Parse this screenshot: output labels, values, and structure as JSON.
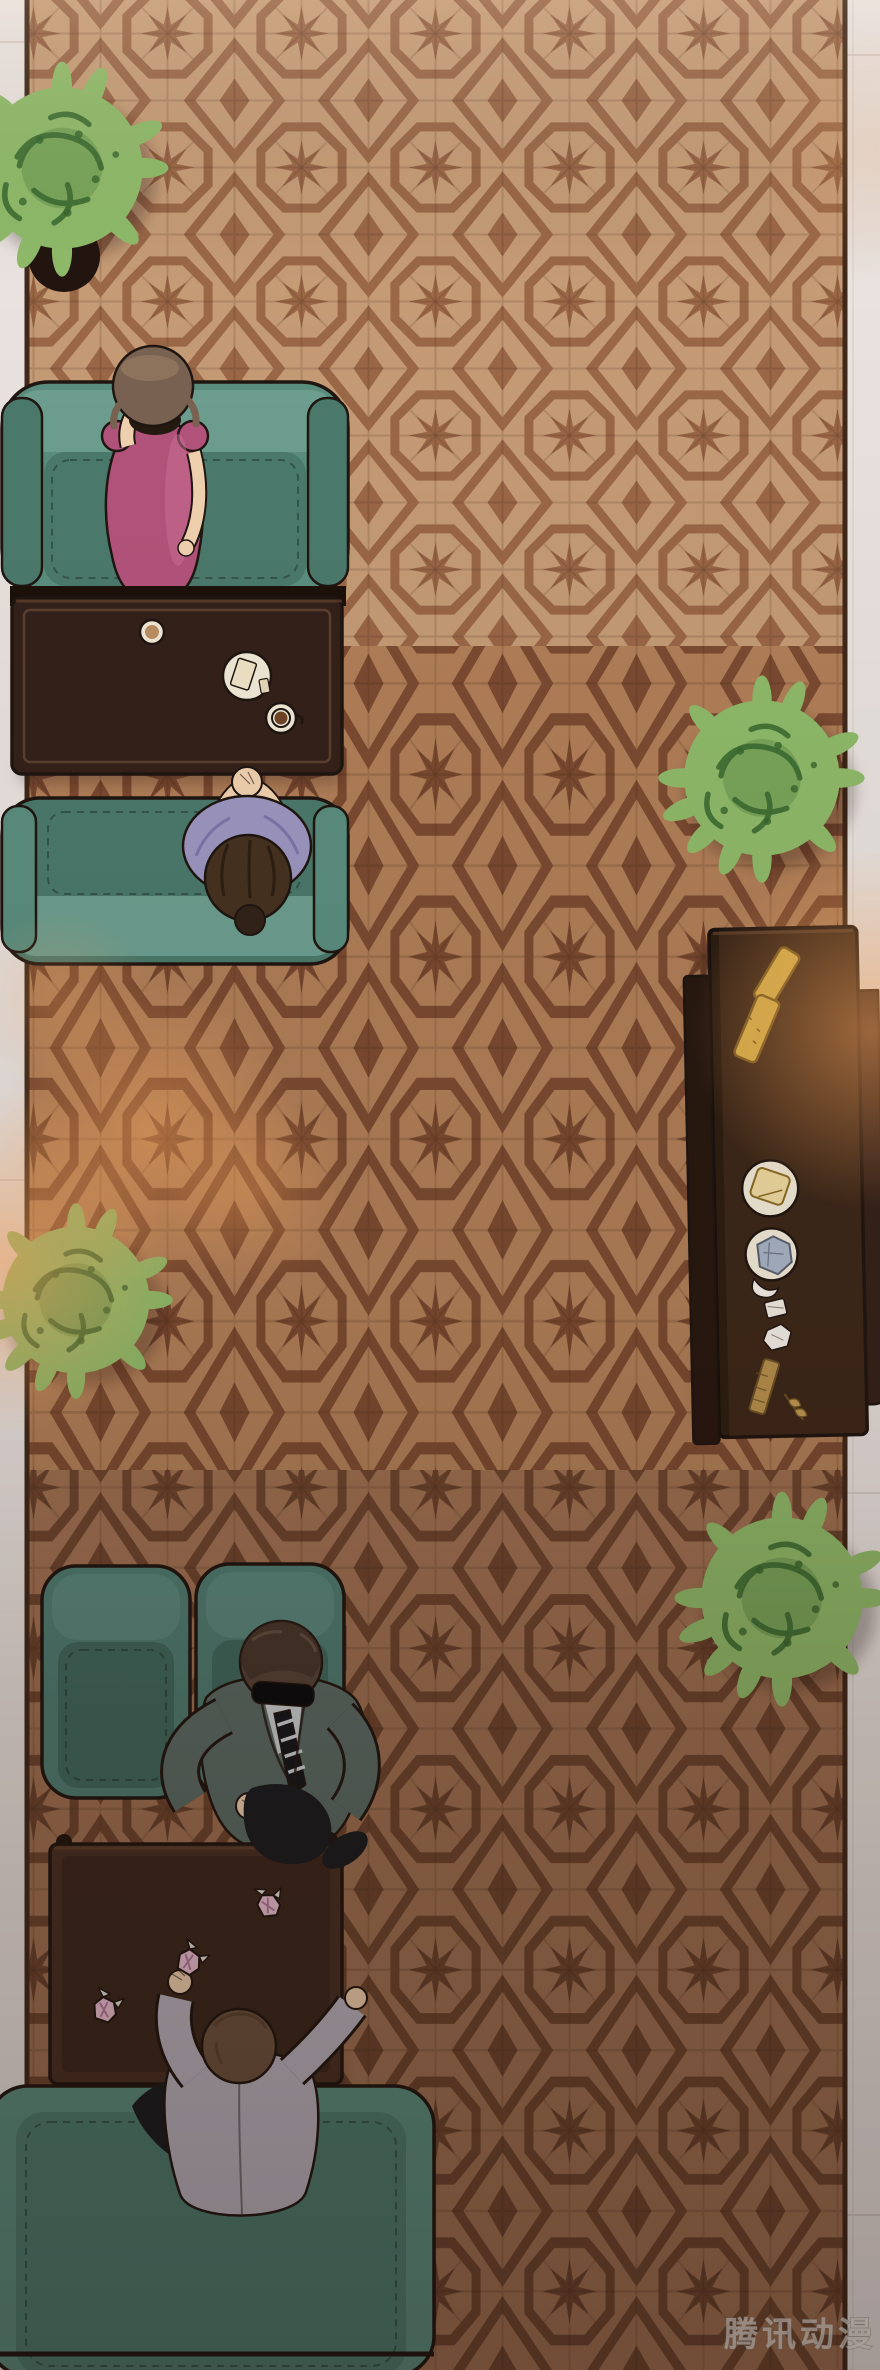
{
  "scene": {
    "type": "webtoon-panel-illustration",
    "view": "top-down hotel lounge scene",
    "watermark": "腾讯动漫",
    "palette": {
      "floor": "#e9e2de",
      "floor_line": "#c6b9b2",
      "carpet_a": "#c59b76",
      "carpet_b": "#b17f58",
      "carpet_c": "#9f7152",
      "motif_a": "#9a6747",
      "motif_b": "#7c4b31",
      "motif_c": "#6d452e",
      "carpet_edge": "#40291a",
      "sofa": "#5b8e7f",
      "sofa_back": "#6d9e8f",
      "sofa_seat": "#4b7a6c",
      "chair": "#4f7d72",
      "chair_seat": "#40695e",
      "table_dark": "#33211a",
      "table_mid": "#483023",
      "table_trim": "#7d5a41",
      "wood": "#3d2819",
      "bench": "#271810",
      "panel": "#35221a",
      "plant": "#8fba69",
      "plant_dark": "#39682f",
      "pot": "#221510",
      "skin": "#f1d2b0",
      "hair_w": "#7a6252",
      "hair_bun": "#46321f",
      "hair_m": "#564337",
      "hair_g": "#6d533e",
      "dress": "#b3537b",
      "dress_hi": "#cd7298",
      "blouse": "#9d97c1",
      "suit": "#5b6b65",
      "pants": "#1a1c21",
      "gray_suit": "#b9b4be",
      "shirt": "#ced3d5",
      "tie": "#14161a",
      "bread": "#d7b14b",
      "bread_line": "#7c5f22",
      "candy": "#ecc0d4",
      "candy_line": "#b27898",
      "coffee": "#6f4526",
      "porcelain": "#f2ead8",
      "glow": "#ffa95e",
      "ink": "#201611"
    },
    "objects": [
      {
        "id": "plant-top-left",
        "label": "potted plant, top view"
      },
      {
        "id": "sofa-top",
        "label": "teal two-seat sofa"
      },
      {
        "id": "woman-pink",
        "label": "woman in pink dress, hand raised to face"
      },
      {
        "id": "coffee-table",
        "label": "dark wooden coffee table"
      },
      {
        "id": "coaster",
        "label": "round coaster"
      },
      {
        "id": "dessert-plate",
        "label": "plate with folded napkin and sugar"
      },
      {
        "id": "coffee-cup",
        "label": "coffee cup on saucer"
      },
      {
        "id": "sofa-middle",
        "label": "teal sofa"
      },
      {
        "id": "woman-purple",
        "label": "seated woman in lavender blouse, hands clasped"
      },
      {
        "id": "plant-right-upper",
        "label": "potted plant"
      },
      {
        "id": "sideboard",
        "label": "long wooden sideboard along right wall"
      },
      {
        "id": "baguette-1",
        "label": "baguette"
      },
      {
        "id": "baguette-2",
        "label": "baguette"
      },
      {
        "id": "plate-pastry",
        "label": "plate with square pastry"
      },
      {
        "id": "plate-blue",
        "label": "plate with blue-gray dish and napkin"
      },
      {
        "id": "sugar-packet",
        "label": "small paper packet"
      },
      {
        "id": "crumpled-napkin",
        "label": "crumpled napkin"
      },
      {
        "id": "wafer-stick",
        "label": "golden wafer stick"
      },
      {
        "id": "leaf-garnish",
        "label": "golden leaf garnish"
      },
      {
        "id": "plant-left",
        "label": "potted plant"
      },
      {
        "id": "plant-right-lower",
        "label": "potted plant"
      },
      {
        "id": "armchair-left",
        "label": "teal armchair"
      },
      {
        "id": "armchair-right",
        "label": "teal armchair"
      },
      {
        "id": "man-suit",
        "label": "man in dark suit, sunglasses, striped tie, hands on knees"
      },
      {
        "id": "low-table",
        "label": "wooden low table with corner posts"
      },
      {
        "id": "candy-1",
        "label": "pink wrapped candy"
      },
      {
        "id": "candy-2",
        "label": "pink wrapped candy held in hand"
      },
      {
        "id": "candy-3",
        "label": "pink wrapped candy"
      },
      {
        "id": "man-gray",
        "label": "man in light gray suit reaching across table"
      },
      {
        "id": "sofa-bottom",
        "label": "large teal sofa"
      },
      {
        "id": "light-glows",
        "label": "warm lamp light pools"
      }
    ]
  }
}
